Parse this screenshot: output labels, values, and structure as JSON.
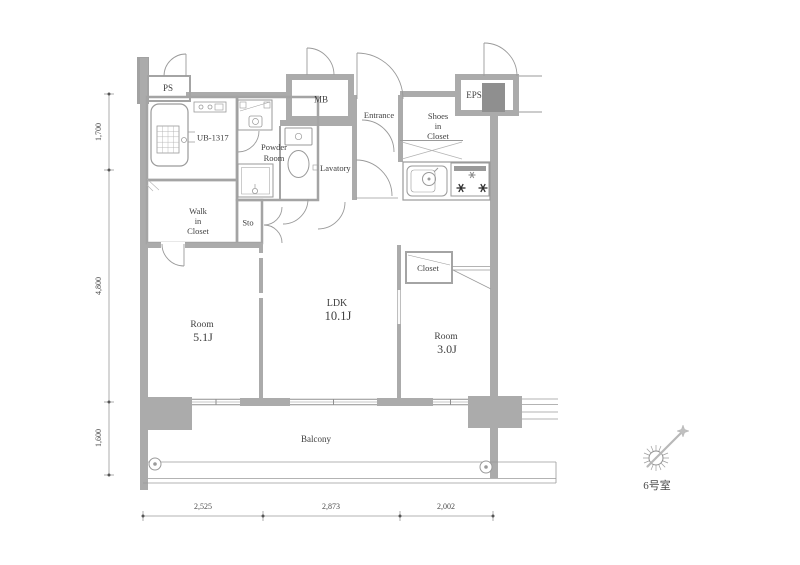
{
  "plan": {
    "rooms": {
      "ps": {
        "label": "PS"
      },
      "bath": {
        "label": "UB-1317"
      },
      "powder_room": {
        "line1": "Powder",
        "line2": "Room"
      },
      "mb": {
        "label": "MB"
      },
      "entrance": {
        "label": "Entrance"
      },
      "shoes_closet": {
        "line1": "Shoes",
        "line2": "in",
        "line3": "Closet"
      },
      "eps": {
        "label": "EPS"
      },
      "lavatory": {
        "label": "Lavatory"
      },
      "walk_in_closet": {
        "line1": "Walk",
        "line2": "in",
        "line3": "Closet"
      },
      "storage": {
        "label": "Sto"
      },
      "room_51": {
        "line1": "Room",
        "line2": "5.1J"
      },
      "ldk": {
        "line1": "LDK",
        "line2": "10.1J"
      },
      "closet": {
        "label": "Closet"
      },
      "room_30": {
        "line1": "Room",
        "line2": "3.0J"
      },
      "balcony": {
        "label": "Balcony"
      }
    },
    "dimensions": {
      "left": [
        "1,700",
        "4,800",
        "1,600"
      ],
      "bottom": [
        "2,525",
        "2,873",
        "2,002"
      ]
    },
    "compass": {
      "unit_label": "6号室"
    },
    "colors": {
      "wall": "#ababab",
      "wall_dark": "#8f8f8f",
      "line": "#9a9a9a",
      "text": "#3f3f3f",
      "burner_dark": "#2f2f2f",
      "burner_light": "#8f8f8f"
    }
  }
}
